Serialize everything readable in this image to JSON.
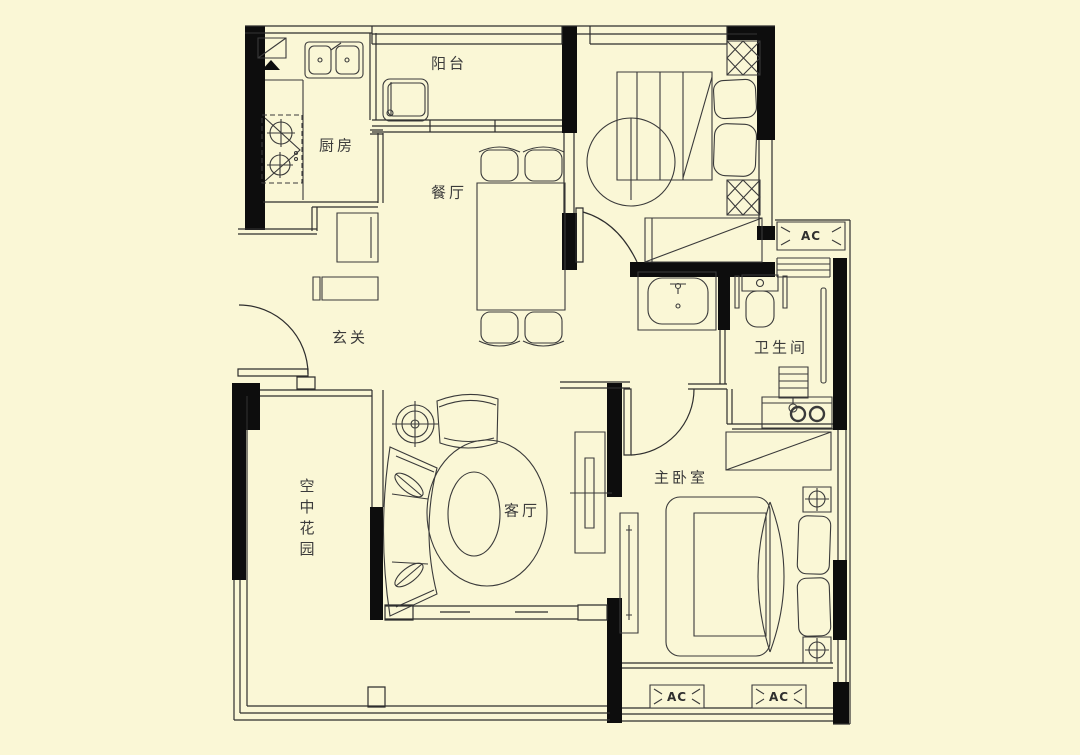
{
  "page": {
    "type": "apartment-floor-plan",
    "background_color": "#faf7d6",
    "line_color": "#2e2e2e",
    "wall_color": "#0d0d0d"
  },
  "rooms": {
    "balcony": {
      "label": "阳台"
    },
    "kitchen": {
      "label": "厨房"
    },
    "dining": {
      "label": "餐厅"
    },
    "entry_hall": {
      "label": "玄关"
    },
    "bathroom": {
      "label": "卫生间"
    },
    "living_room": {
      "label": "客厅"
    },
    "master_bedroom": {
      "label": "主卧室"
    },
    "sky_garden": {
      "label": "空中花园"
    }
  },
  "ac_units": {
    "top_right": {
      "label": "AC"
    },
    "bottom_left": {
      "label": "AC"
    },
    "bottom_right": {
      "label": "AC"
    }
  }
}
